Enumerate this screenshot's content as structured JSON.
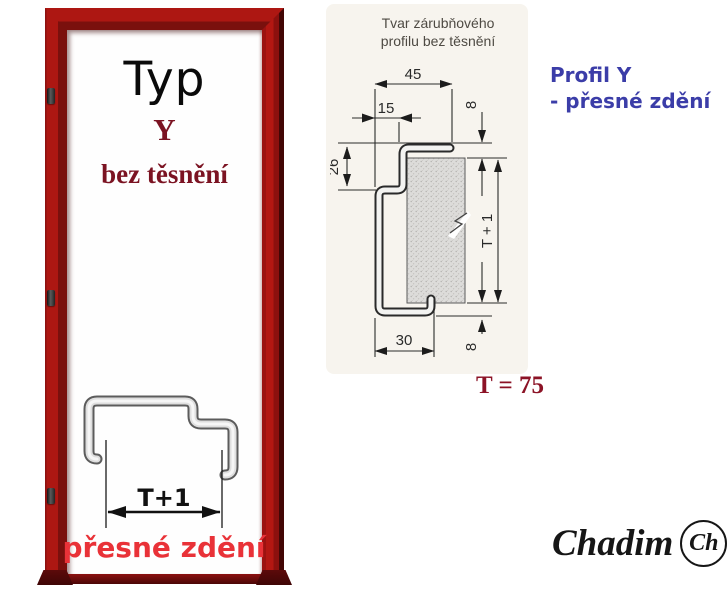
{
  "door": {
    "type_label": "Typ",
    "variant": "Y",
    "seal_note": "bez těsnění",
    "sketch_dim": "T+1",
    "masonry_note": "přesné zdění"
  },
  "drawing": {
    "title_line1": "Tvar zárubňového",
    "title_line2": "profilu bez těsnění",
    "dims": {
      "overall_width": "45",
      "face_width": "15",
      "rebate_depth": "26",
      "top_flange": "8",
      "wall_span": "T + 1",
      "throat_width": "30",
      "bottom_flange": "8"
    }
  },
  "callout": {
    "profile_name": "Profil Y",
    "profile_note": "- přesné zdění",
    "thickness_value": "T = 75"
  },
  "logo": {
    "wordmark": "Chadim",
    "monogram": "Ch"
  },
  "colors": {
    "frame_red": "#ad1712",
    "maroon_text": "#7b1322",
    "bright_red_text": "#e93238",
    "blue_text": "#3b3da8",
    "thickness_red": "#8c1326"
  }
}
